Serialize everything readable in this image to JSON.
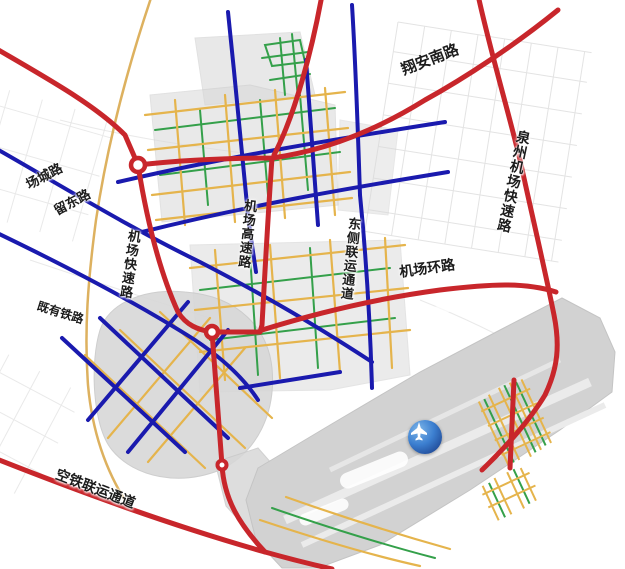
{
  "labels": [
    {
      "name": "xiangan-south-road",
      "text": "翔安南路"
    },
    {
      "name": "quanzhou-airport-expressway",
      "text": "泉州机场快速路"
    },
    {
      "name": "changcheng-road",
      "text": "场城路"
    },
    {
      "name": "liudong-road",
      "text": "留东路"
    },
    {
      "name": "airport-express-road",
      "text": "机场快速路"
    },
    {
      "name": "airport-highway",
      "text": "机场高速路"
    },
    {
      "name": "east-side-intermodal-corridor",
      "text": "东侧联运通道"
    },
    {
      "name": "airport-ring-road",
      "text": "机场环路"
    },
    {
      "name": "existing-railway",
      "text": "既有铁路"
    },
    {
      "name": "air-rail-intermodal-corridor",
      "text": "空铁联运通道"
    }
  ],
  "airport_marker": {
    "icon": "airplane-icon"
  },
  "colors": {
    "expressway_red": "#c8262b",
    "arterial_blue": "#1a1aae",
    "secondary_yellow": "#e5b44c",
    "branch_green": "#34a04a",
    "railway_tan": "#d9a84e",
    "urban_gray": "#d7d7d7",
    "airport_gray": "#d2d2d2",
    "marker_blue": "#2f6fd0"
  }
}
